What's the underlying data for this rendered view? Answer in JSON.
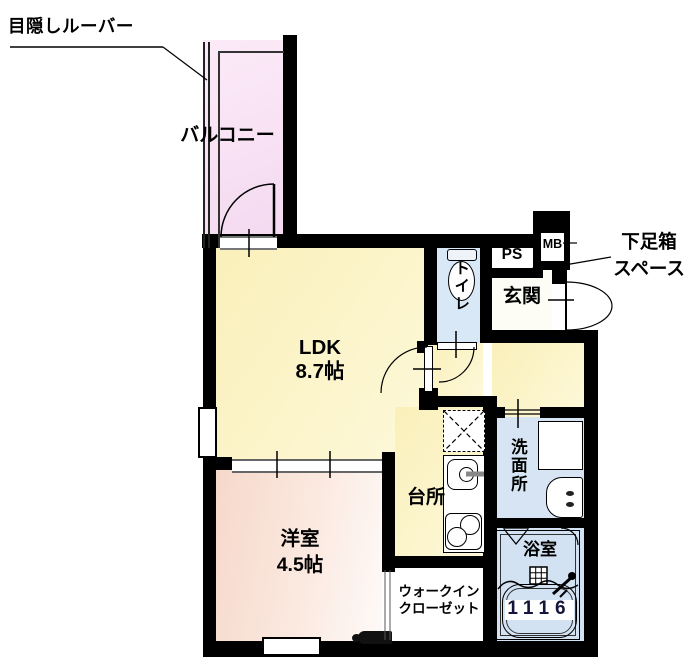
{
  "floorplan": {
    "annotations": {
      "louver_note": "目隠しルーバー",
      "shoebox_note_1": "下足箱",
      "shoebox_note_2": "スペース"
    },
    "rooms": {
      "balcony": "バルコニー",
      "ldk": "LDK",
      "ldk_size": "8.7帖",
      "toilet": "トイレ",
      "ps": "PS",
      "mb": "MB",
      "entrance": "玄関",
      "washroom": "洗面所",
      "kitchen": "台所",
      "western_room": "洋室",
      "western_room_size": "4.5帖",
      "wic_1": "ウォークイン",
      "wic_2": "クローゼット",
      "bathroom": "浴室",
      "bathtub_size": "1116"
    },
    "colors": {
      "wall": "#000000",
      "ldk_floor": "#fbf3c6",
      "balcony_floor": "#f6ddf1",
      "western_floor": "#f7dccf",
      "wet_area_floor": "#d6e4f3",
      "entrance_floor": "#fdfdf5",
      "bath_size_text": "#14143c"
    }
  }
}
